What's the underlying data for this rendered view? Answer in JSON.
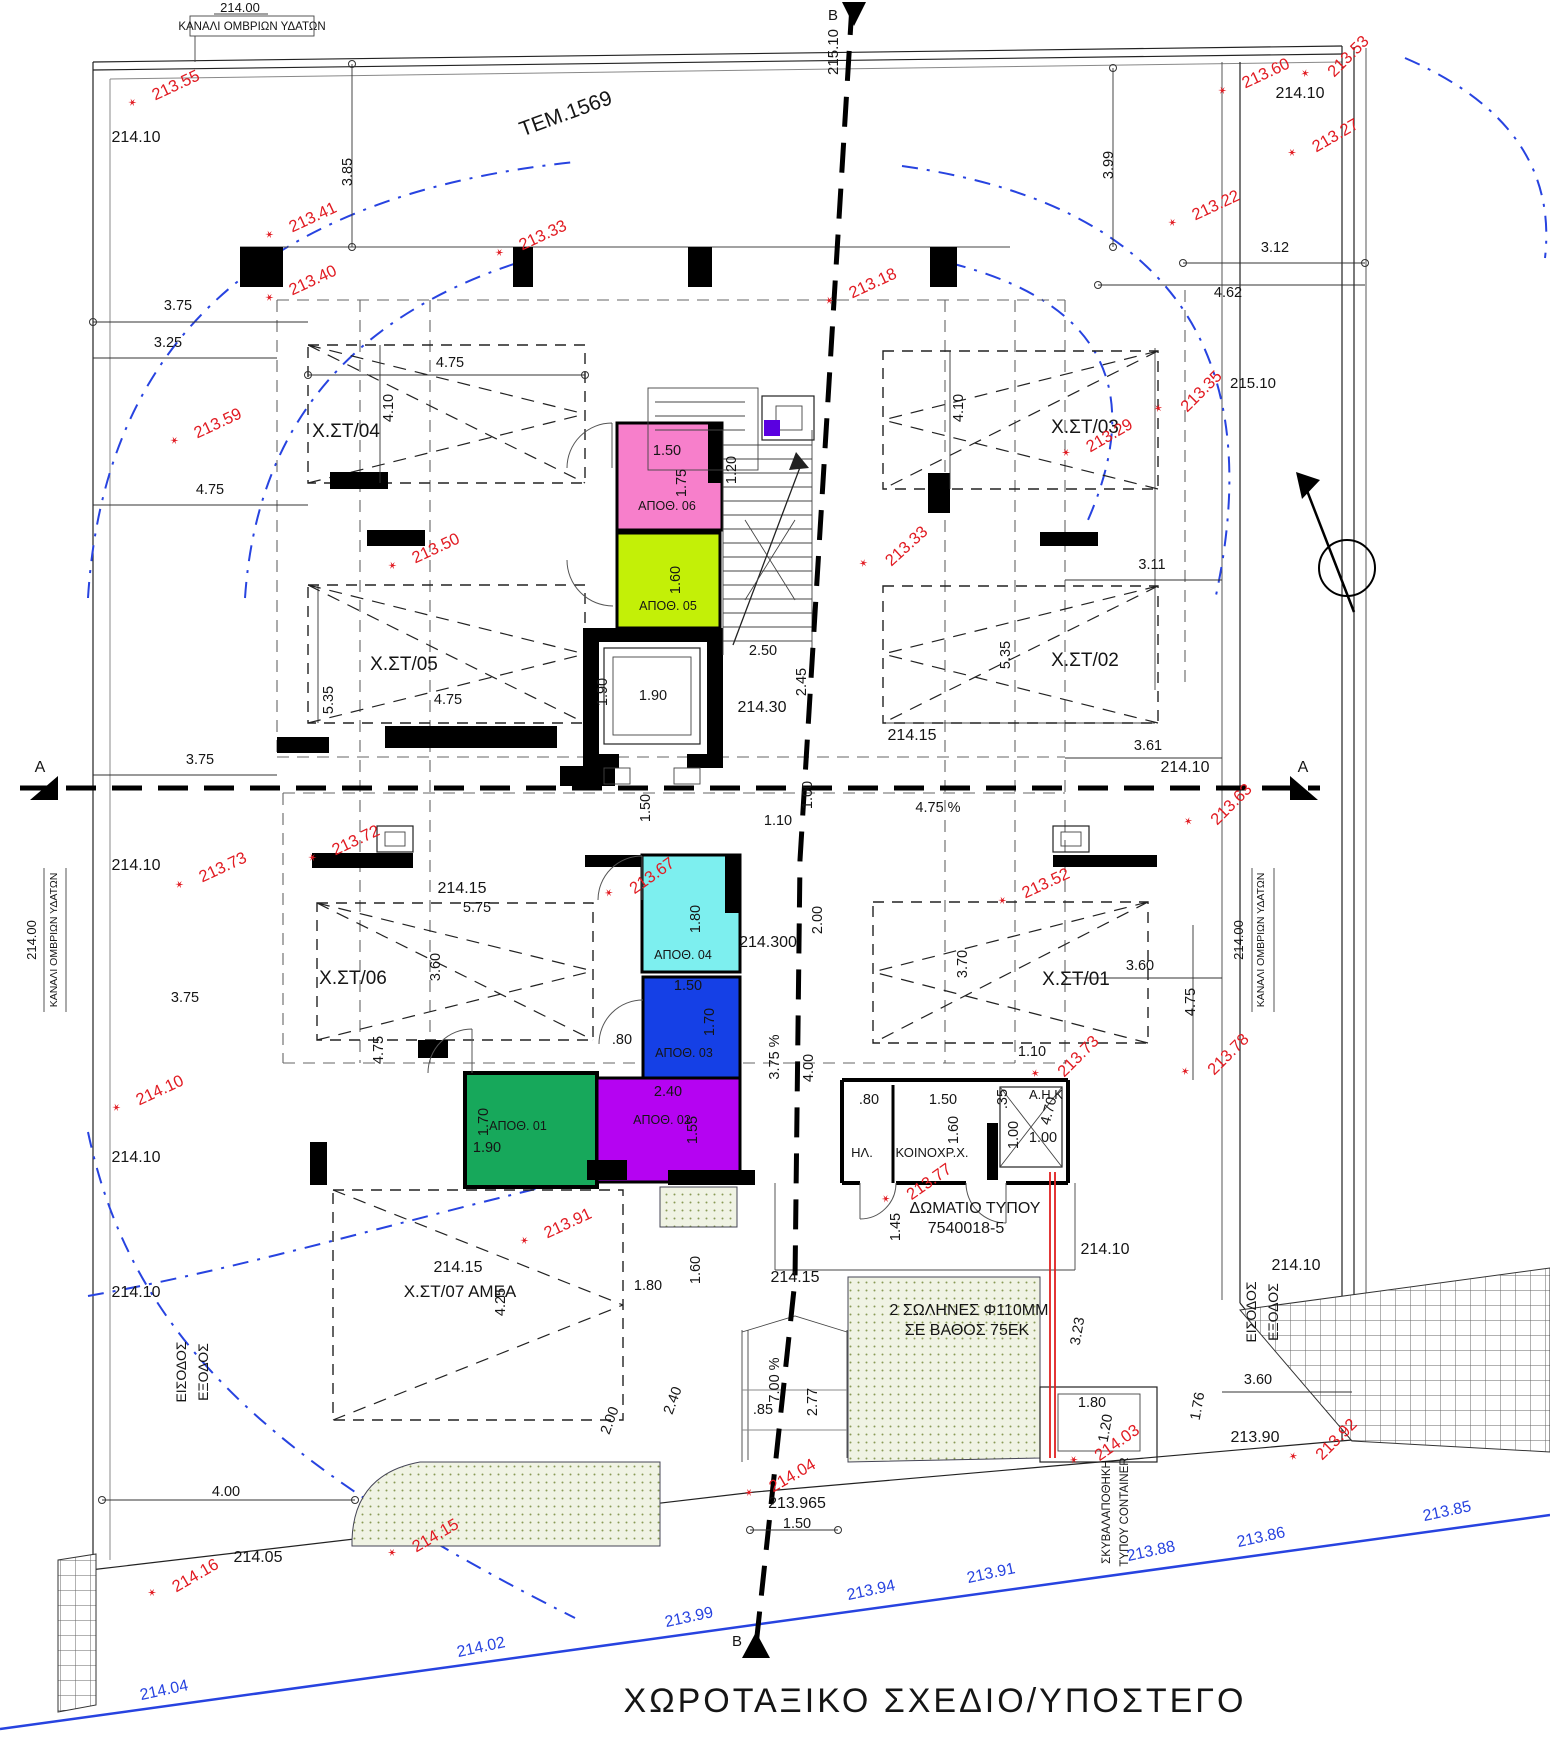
{
  "title": "ΧΩΡΟΤΑΞΙΚΟ ΣΧΕΔΙΟ/ΥΠΟΣΤΕΓΟ",
  "colors": {
    "red_annotation": "#E11B22",
    "blue_annotation": "#2743E0",
    "wall": "#000000",
    "fills": {
      "xst01": "#17A85B",
      "xst02": "#1540E6",
      "xst03": "#7DEFEF",
      "xst04": "#F77FCB",
      "xst05": "#C3F007",
      "xst06": "#B503F2",
      "ap01": "#17A85B",
      "ap02": "#B503F2",
      "ap03": "#1540E6",
      "ap04": "#7DEFEF",
      "ap05": "#C3F007",
      "ap06": "#F77FCB",
      "column_marker": "#5A00E0"
    }
  },
  "labels": {
    "black": [
      {
        "t": "214.00",
        "x": 240,
        "y": 12,
        "fs": 13
      },
      {
        "t": "ΚΑΝΑΛΙ ΟΜΒΡΙΩΝ ΥΔΑΤΩΝ",
        "x": 252,
        "y": 30,
        "fs": 11.5
      },
      {
        "t": "214.10",
        "x": 136,
        "y": 142,
        "fs": 16
      },
      {
        "t": "ΤΕΜ.1569",
        "x": 568,
        "y": 120,
        "fs": 21,
        "r": -20
      },
      {
        "t": "215.10",
        "x": 838,
        "y": 52,
        "fs": 15,
        "r": -90
      },
      {
        "t": "Β",
        "x": 833,
        "y": 20,
        "fs": 15
      },
      {
        "t": "214.10",
        "x": 1300,
        "y": 98,
        "fs": 16
      },
      {
        "t": "215.10",
        "x": 1253,
        "y": 388,
        "fs": 15
      },
      {
        "t": "Α",
        "x": 40,
        "y": 772,
        "fs": 16
      },
      {
        "t": "Α",
        "x": 1303,
        "y": 772,
        "fs": 16
      },
      {
        "t": "214.30",
        "x": 762,
        "y": 712,
        "fs": 16
      },
      {
        "t": "214.15",
        "x": 912,
        "y": 740,
        "fs": 16
      },
      {
        "t": "214.10",
        "x": 136,
        "y": 870,
        "fs": 16
      },
      {
        "t": "214.10",
        "x": 1185,
        "y": 772,
        "fs": 16
      },
      {
        "t": "214.15",
        "x": 462,
        "y": 893,
        "fs": 16
      },
      {
        "t": "214.300",
        "x": 768,
        "y": 947,
        "fs": 16
      },
      {
        "t": "214.00",
        "x": 36,
        "y": 940,
        "fs": 13,
        "r": -90
      },
      {
        "t": "ΚΑΝΑΛΙ ΟΜΒΡΙΩΝ ΥΔΑΤΩΝ",
        "x": 57,
        "y": 940,
        "fs": 10.5,
        "r": -90
      },
      {
        "t": "214.00",
        "x": 1243,
        "y": 940,
        "fs": 13,
        "r": -90
      },
      {
        "t": "ΚΑΝΑΛΙ ΟΜΒΡΙΩΝ ΥΔΑΤΩΝ",
        "x": 1264,
        "y": 940,
        "fs": 10.5,
        "r": -90
      },
      {
        "t": "ΗΛ.",
        "x": 862,
        "y": 1157,
        "fs": 13
      },
      {
        "t": "ΚΟΙΝΟΧΡ.Χ.",
        "x": 932,
        "y": 1157,
        "fs": 13
      },
      {
        "t": "Α.Η.Κ",
        "x": 1046,
        "y": 1099,
        "fs": 13
      },
      {
        "t": "ΔΩΜΑΤΙΟ ΤΥΠΟΥ",
        "x": 975,
        "y": 1213,
        "fs": 16
      },
      {
        "t": "7540018-5",
        "x": 966,
        "y": 1233,
        "fs": 16
      },
      {
        "t": "214.15",
        "x": 458,
        "y": 1272,
        "fs": 16
      },
      {
        "t": "Χ.ΣΤ/07 ΑΜΕΑ",
        "x": 460,
        "y": 1297,
        "fs": 17
      },
      {
        "t": "214.15",
        "x": 795,
        "y": 1282,
        "fs": 16
      },
      {
        "t": "214.10",
        "x": 136,
        "y": 1162,
        "fs": 16
      },
      {
        "t": "214.10",
        "x": 136,
        "y": 1297,
        "fs": 16
      },
      {
        "t": "214.10",
        "x": 1105,
        "y": 1254,
        "fs": 16
      },
      {
        "t": "214.10",
        "x": 1296,
        "y": 1270,
        "fs": 16
      },
      {
        "t": "2 ΣΩΛΗΝΕΣ Φ110ΜΜ",
        "x": 969,
        "y": 1315,
        "fs": 16
      },
      {
        "t": "ΣΕ ΒΑΘΟΣ 75ΕΚ",
        "x": 967,
        "y": 1335,
        "fs": 16
      },
      {
        "t": "ΕΙΣΟΔΟΣ",
        "x": 186,
        "y": 1372,
        "fs": 14,
        "r": -90
      },
      {
        "t": "ΕΞΟΔΟΣ",
        "x": 208,
        "y": 1372,
        "fs": 14,
        "r": -90
      },
      {
        "t": "ΕΙΣΟΔΟΣ",
        "x": 1256,
        "y": 1312,
        "fs": 14,
        "r": -90
      },
      {
        "t": "ΕΞΟΔΟΣ",
        "x": 1278,
        "y": 1312,
        "fs": 14,
        "r": -90
      },
      {
        "t": "213.90",
        "x": 1255,
        "y": 1442,
        "fs": 16
      },
      {
        "t": "214.05",
        "x": 258,
        "y": 1562,
        "fs": 16
      },
      {
        "t": "213.965",
        "x": 797,
        "y": 1508,
        "fs": 16
      },
      {
        "t": "ΣΚΥΒΑΛΑΠΟΘΗΚΗ",
        "x": 1110,
        "y": 1512,
        "fs": 11.5,
        "r": -90
      },
      {
        "t": "ΤΥΠΟΥ CONTAINER",
        "x": 1128,
        "y": 1512,
        "fs": 11.5,
        "r": -90
      },
      {
        "t": "Β",
        "x": 737,
        "y": 1646,
        "fs": 15
      }
    ],
    "parking": [
      {
        "t": "Χ.ΣΤ/04",
        "x": 346,
        "y": 437
      },
      {
        "t": "Χ.ΣΤ/03",
        "x": 1085,
        "y": 433
      },
      {
        "t": "Χ.ΣΤ/05",
        "x": 404,
        "y": 670
      },
      {
        "t": "Χ.ΣΤ/02",
        "x": 1085,
        "y": 666
      },
      {
        "t": "Χ.ΣΤ/06",
        "x": 353,
        "y": 984
      },
      {
        "t": "Χ.ΣΤ/01",
        "x": 1076,
        "y": 985
      }
    ],
    "storage": [
      {
        "t": "ΑΠΟΘ. 06",
        "x": 667,
        "y": 510
      },
      {
        "t": "ΑΠΟΘ. 05",
        "x": 668,
        "y": 610
      },
      {
        "t": "ΑΠΟΘ. 04",
        "x": 683,
        "y": 959
      },
      {
        "t": "ΑΠΟΘ. 03",
        "x": 684,
        "y": 1057
      },
      {
        "t": "ΑΠΟΘ. 01",
        "x": 518,
        "y": 1130
      },
      {
        "t": "ΑΠΟΘ. 02",
        "x": 662,
        "y": 1124
      }
    ],
    "dims": [
      {
        "t": "3.85",
        "x": 352,
        "y": 172,
        "r": -90
      },
      {
        "t": "3.99",
        "x": 1113,
        "y": 165,
        "r": -90
      },
      {
        "t": "3.12",
        "x": 1275,
        "y": 252
      },
      {
        "t": "4.62",
        "x": 1228,
        "y": 297
      },
      {
        "t": "3.75",
        "x": 178,
        "y": 310
      },
      {
        "t": "3.25",
        "x": 168,
        "y": 347
      },
      {
        "t": "4.75",
        "x": 450,
        "y": 367
      },
      {
        "t": "4.10",
        "x": 393,
        "y": 408,
        "r": -90
      },
      {
        "t": "4.10",
        "x": 963,
        "y": 408,
        "r": -90
      },
      {
        "t": "1.50",
        "x": 667,
        "y": 455
      },
      {
        "t": "1.75",
        "x": 686,
        "y": 483,
        "r": -90
      },
      {
        "t": "1.20",
        "x": 736,
        "y": 470,
        "r": -90
      },
      {
        "t": "4.75",
        "x": 210,
        "y": 494
      },
      {
        "t": "1.60",
        "x": 680,
        "y": 580,
        "r": -90
      },
      {
        "t": "2.50",
        "x": 763,
        "y": 655
      },
      {
        "t": "2.45",
        "x": 806,
        "y": 682,
        "r": -90
      },
      {
        "t": "3.11",
        "x": 1152,
        "y": 569
      },
      {
        "t": "5.35",
        "x": 333,
        "y": 700,
        "r": -90
      },
      {
        "t": "4.75",
        "x": 448,
        "y": 704
      },
      {
        "t": "1.90",
        "x": 607,
        "y": 692,
        "r": -90
      },
      {
        "t": "1.90",
        "x": 653,
        "y": 700
      },
      {
        "t": "5.35",
        "x": 1010,
        "y": 655,
        "r": -90
      },
      {
        "t": "3.75",
        "x": 200,
        "y": 764
      },
      {
        "t": "1.50",
        "x": 650,
        "y": 808,
        "r": -90
      },
      {
        "t": "1.10",
        "x": 778,
        "y": 825
      },
      {
        "t": "1.00",
        "x": 812,
        "y": 795,
        "r": -90
      },
      {
        "t": "4.75  %",
        "x": 938,
        "y": 812
      },
      {
        "t": "3.61",
        "x": 1148,
        "y": 750
      },
      {
        "t": "5.75",
        "x": 477,
        "y": 912
      },
      {
        "t": "1.80",
        "x": 700,
        "y": 919,
        "r": -90
      },
      {
        "t": "2.00",
        "x": 822,
        "y": 920,
        "r": -90
      },
      {
        "t": "3.60",
        "x": 440,
        "y": 967,
        "r": -90
      },
      {
        "t": "3.70",
        "x": 967,
        "y": 964,
        "r": -90
      },
      {
        "t": "4.75",
        "x": 1195,
        "y": 1002,
        "r": -90
      },
      {
        "t": "1.50",
        "x": 688,
        "y": 990
      },
      {
        "t": "1.70",
        "x": 714,
        "y": 1022,
        "r": -90
      },
      {
        "t": ".80",
        "x": 622,
        "y": 1044
      },
      {
        "t": "3.75  %",
        "x": 779,
        "y": 1057,
        "r": -90
      },
      {
        "t": "4.00",
        "x": 813,
        "y": 1068,
        "r": -90
      },
      {
        "t": "1.10",
        "x": 1032,
        "y": 1056
      },
      {
        "t": "3.60",
        "x": 1140,
        "y": 970
      },
      {
        "t": ".80",
        "x": 869,
        "y": 1104
      },
      {
        "t": "1.50",
        "x": 943,
        "y": 1104
      },
      {
        "t": ".35",
        "x": 1007,
        "y": 1099,
        "r": -90
      },
      {
        "t": "1.60",
        "x": 958,
        "y": 1130,
        "r": -90
      },
      {
        "t": "1.00",
        "x": 1018,
        "y": 1135,
        "r": -90
      },
      {
        "t": "1.00",
        "x": 1043,
        "y": 1142
      },
      {
        "t": "4.75",
        "x": 383,
        "y": 1050,
        "r": -90
      },
      {
        "t": "1.70",
        "x": 488,
        "y": 1122,
        "r": -90
      },
      {
        "t": "1.90",
        "x": 487,
        "y": 1152
      },
      {
        "t": "2.40",
        "x": 668,
        "y": 1096
      },
      {
        "t": "1.55",
        "x": 697,
        "y": 1130,
        "r": -90
      },
      {
        "t": "1.45",
        "x": 900,
        "y": 1227,
        "r": -90
      },
      {
        "t": "4.70",
        "x": 1053,
        "y": 1112,
        "r": -75
      },
      {
        "t": "3.75",
        "x": 185,
        "y": 1002
      },
      {
        "t": "4.25",
        "x": 505,
        "y": 1302,
        "r": -90
      },
      {
        "t": "1.80",
        "x": 648,
        "y": 1290
      },
      {
        "t": "1.60",
        "x": 700,
        "y": 1270,
        "r": -90
      },
      {
        "t": "3.23",
        "x": 1082,
        "y": 1332,
        "r": -80
      },
      {
        "t": "3.60",
        "x": 1258,
        "y": 1384
      },
      {
        "t": "1.76",
        "x": 1202,
        "y": 1407,
        "r": -80
      },
      {
        "t": "1.80",
        "x": 1092,
        "y": 1407
      },
      {
        "t": "1.20",
        "x": 1110,
        "y": 1429,
        "r": -80
      },
      {
        "t": "2.00",
        "x": 614,
        "y": 1422,
        "r": -70
      },
      {
        "t": "2.40",
        "x": 677,
        "y": 1402,
        "r": -70
      },
      {
        "t": "7.00  %",
        "x": 779,
        "y": 1380,
        "r": -90
      },
      {
        "t": ".85",
        "x": 763,
        "y": 1414
      },
      {
        "t": "2.77",
        "x": 817,
        "y": 1402,
        "r": -90
      },
      {
        "t": "4.00",
        "x": 226,
        "y": 1496
      },
      {
        "t": "1.50",
        "x": 797,
        "y": 1528
      }
    ],
    "red": [
      {
        "t": "213.55",
        "x": 178,
        "y": 90,
        "r": -25
      },
      {
        "t": "213.41",
        "x": 315,
        "y": 222,
        "r": -25
      },
      {
        "t": "213.33",
        "x": 545,
        "y": 240,
        "r": -25
      },
      {
        "t": "213.18",
        "x": 875,
        "y": 288,
        "r": -25
      },
      {
        "t": "213.40",
        "x": 315,
        "y": 285,
        "r": -25
      },
      {
        "t": "213.60",
        "x": 1268,
        "y": 78,
        "r": -25
      },
      {
        "t": "213.53",
        "x": 1352,
        "y": 60,
        "r": -45
      },
      {
        "t": "213.27",
        "x": 1338,
        "y": 140,
        "r": -30
      },
      {
        "t": "213.22",
        "x": 1218,
        "y": 210,
        "r": -25
      },
      {
        "t": "213.35",
        "x": 1205,
        "y": 395,
        "r": -45
      },
      {
        "t": "213.59",
        "x": 220,
        "y": 428,
        "r": -25
      },
      {
        "t": "213.29",
        "x": 1112,
        "y": 440,
        "r": -30
      },
      {
        "t": "213.50",
        "x": 438,
        "y": 553,
        "r": -25
      },
      {
        "t": "213.33",
        "x": 910,
        "y": 550,
        "r": -42
      },
      {
        "t": "213.72",
        "x": 358,
        "y": 845,
        "r": -25
      },
      {
        "t": "213.73",
        "x": 225,
        "y": 872,
        "r": -25
      },
      {
        "t": "213.67",
        "x": 655,
        "y": 880,
        "r": -35
      },
      {
        "t": "213.52",
        "x": 1048,
        "y": 888,
        "r": -25
      },
      {
        "t": "213.63",
        "x": 1235,
        "y": 808,
        "r": -45
      },
      {
        "t": "213.77",
        "x": 932,
        "y": 1186,
        "r": -35
      },
      {
        "t": "213.73",
        "x": 1082,
        "y": 1060,
        "r": -45
      },
      {
        "t": "213.78",
        "x": 1232,
        "y": 1058,
        "r": -45
      },
      {
        "t": "214.10",
        "x": 162,
        "y": 1095,
        "r": -25
      },
      {
        "t": "213.91",
        "x": 570,
        "y": 1228,
        "r": -25
      },
      {
        "t": "214.16",
        "x": 198,
        "y": 1580,
        "r": -30
      },
      {
        "t": "214.15",
        "x": 438,
        "y": 1540,
        "r": -30
      },
      {
        "t": "214.03",
        "x": 1120,
        "y": 1447,
        "r": -35
      },
      {
        "t": "213.92",
        "x": 1340,
        "y": 1443,
        "r": -45
      },
      {
        "t": "214.04",
        "x": 795,
        "y": 1480,
        "r": -30
      }
    ],
    "blue": [
      {
        "t": "214.04",
        "x": 165,
        "y": 1695,
        "r": -12
      },
      {
        "t": "214.02",
        "x": 482,
        "y": 1652,
        "r": -12
      },
      {
        "t": "213.99",
        "x": 690,
        "y": 1622,
        "r": -12
      },
      {
        "t": "213.94",
        "x": 872,
        "y": 1595,
        "r": -12
      },
      {
        "t": "213.91",
        "x": 992,
        "y": 1578,
        "r": -12
      },
      {
        "t": "213.88",
        "x": 1152,
        "y": 1556,
        "r": -12
      },
      {
        "t": "213.86",
        "x": 1262,
        "y": 1542,
        "r": -12
      },
      {
        "t": "213.85",
        "x": 1448,
        "y": 1516,
        "r": -12
      }
    ]
  }
}
